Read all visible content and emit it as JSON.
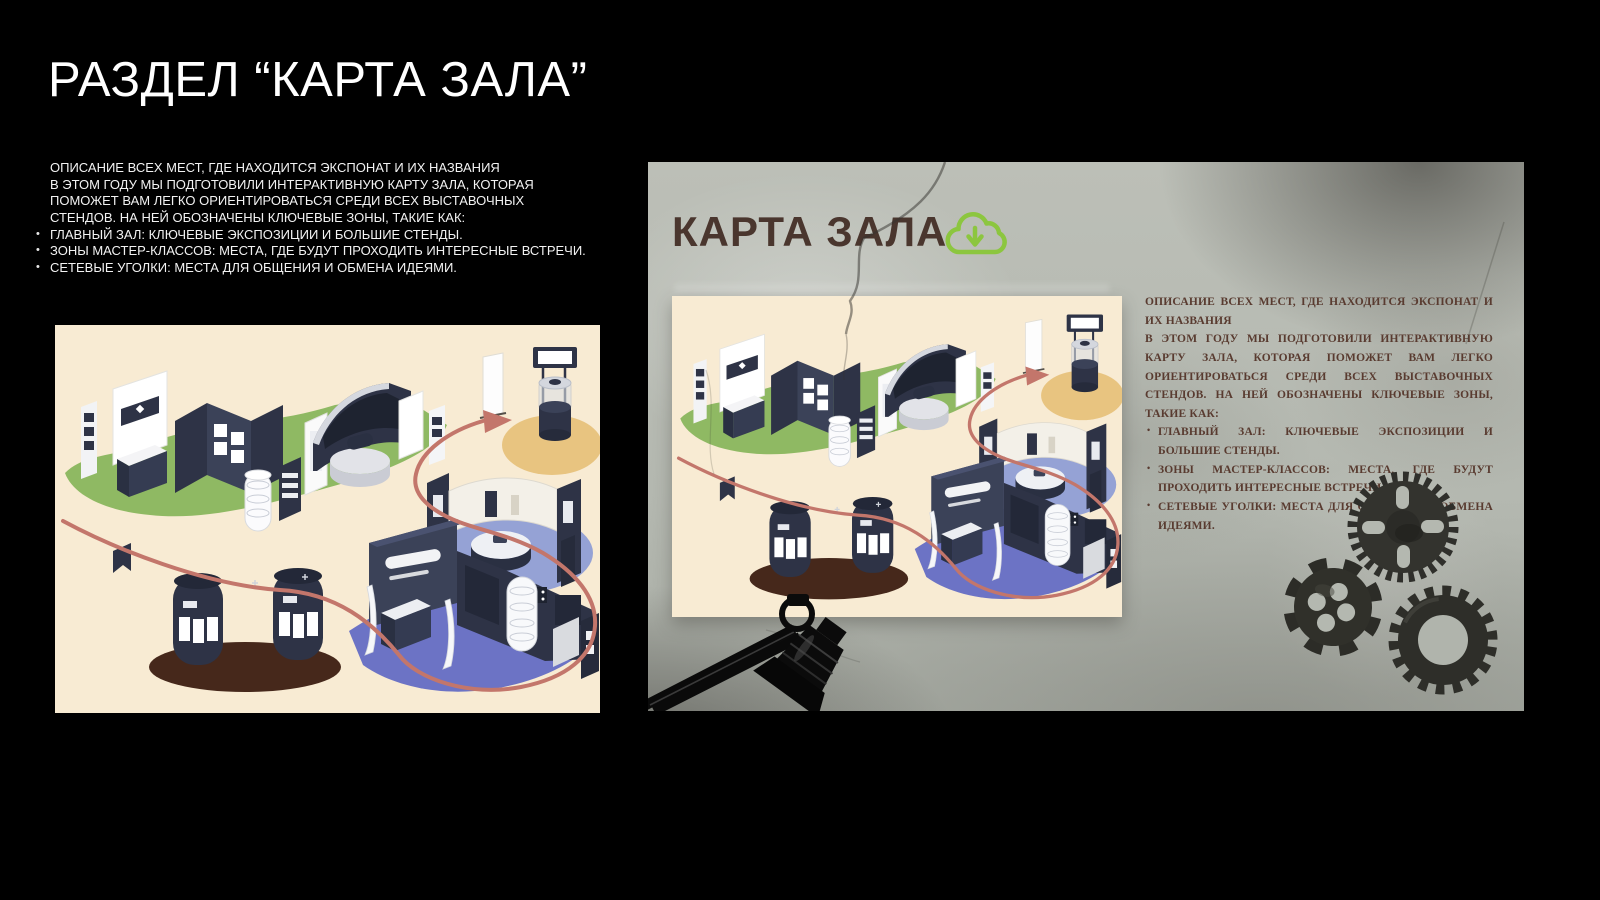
{
  "slide": {
    "title": "РАЗДЕЛ “КАРТА ЗАЛА”",
    "description": {
      "line1": "ОПИСАНИЕ ВСЕХ МЕСТ, ГДЕ НАХОДИТСЯ ЭКСПОНАТ И ИХ НАЗВАНИЯ",
      "line2": "В ЭТОМ ГОДУ МЫ ПОДГОТОВИЛИ ИНТЕРАКТИВНУЮ КАРТУ ЗАЛА, КОТОРАЯ ПОМОЖЕТ ВАМ ЛЕГКО ОРИЕНТИРОВАТЬСЯ СРЕДИ ВСЕХ ВЫСТАВОЧНЫХ СТЕНДОВ. НА НЕЙ ОБОЗНАЧЕНЫ КЛЮЧЕВЫЕ ЗОНЫ, ТАКИЕ КАК:",
      "bullets": [
        "ГЛАВНЫЙ ЗАЛ: КЛЮЧЕВЫЕ ЭКСПОЗИЦИИ И БОЛЬШИЕ СТЕНДЫ.",
        "ЗОНЫ МАСТЕР-КЛАССОВ: МЕСТА, ГДЕ БУДУТ ПРОХОДИТЬ ИНТЕРЕСНЫЕ ВСТРЕЧИ.",
        "СЕТЕВЫЕ УГОЛКИ: МЕСТА ДЛЯ ОБЩЕНИЯ И ОБМЕНА ИДЕЯМИ."
      ]
    }
  },
  "mockup": {
    "header": "КАРТА ЗАЛА",
    "download_icon": "cloud-download-icon",
    "description": {
      "line1": "ОПИСАНИЕ ВСЕХ МЕСТ, ГДЕ НАХОДИТСЯ ЭКСПОНАТ И ИХ НАЗВАНИЯ",
      "line2": "В ЭТОМ ГОДУ МЫ ПОДГОТОВИЛИ ИНТЕРАКТИВНУЮ КАРТУ ЗАЛА, КОТОРАЯ ПОМОЖЕТ ВАМ ЛЕГКО ОРИЕНТИРОВАТЬСЯ СРЕДИ ВСЕХ ВЫСТАВОЧНЫХ СТЕНДОВ. НА НЕЙ ОБОЗНАЧЕНЫ КЛЮЧЕВЫЕ ЗОНЫ, ТАКИЕ КАК:",
      "bullets": [
        "ГЛАВНЫЙ ЗАЛ: КЛЮЧЕВЫЕ ЭКСПОЗИЦИИ И БОЛЬШИЕ СТЕНДЫ.",
        "ЗОНЫ МАСТЕР-КЛАССОВ: МЕСТА, ГДЕ БУДУТ ПРОХОДИТЬ ИНТЕРЕСНЫЕ ВСТРЕЧИ.",
        "СЕТЕВЫЕ УГОЛКИ: МЕСТА ДЛЯ ОБЩЕНИЯ И ОБМЕНА ИДЕЯМИ."
      ]
    }
  },
  "colors": {
    "accent_green": "#8CC63F",
    "header_brown": "#4A362E",
    "body_text_brown": "#593B30",
    "map_cream": "#F8EBD3",
    "zone_green": "#8FB963",
    "zone_tan": "#E8C480",
    "zone_periwinkle": "#95A2D5",
    "zone_purple": "#6C73C5",
    "zone_brown": "#46281B",
    "stand_navy": "#2E3346",
    "route_red": "#C3766B",
    "concrete_grey": "#B7BBB3"
  }
}
